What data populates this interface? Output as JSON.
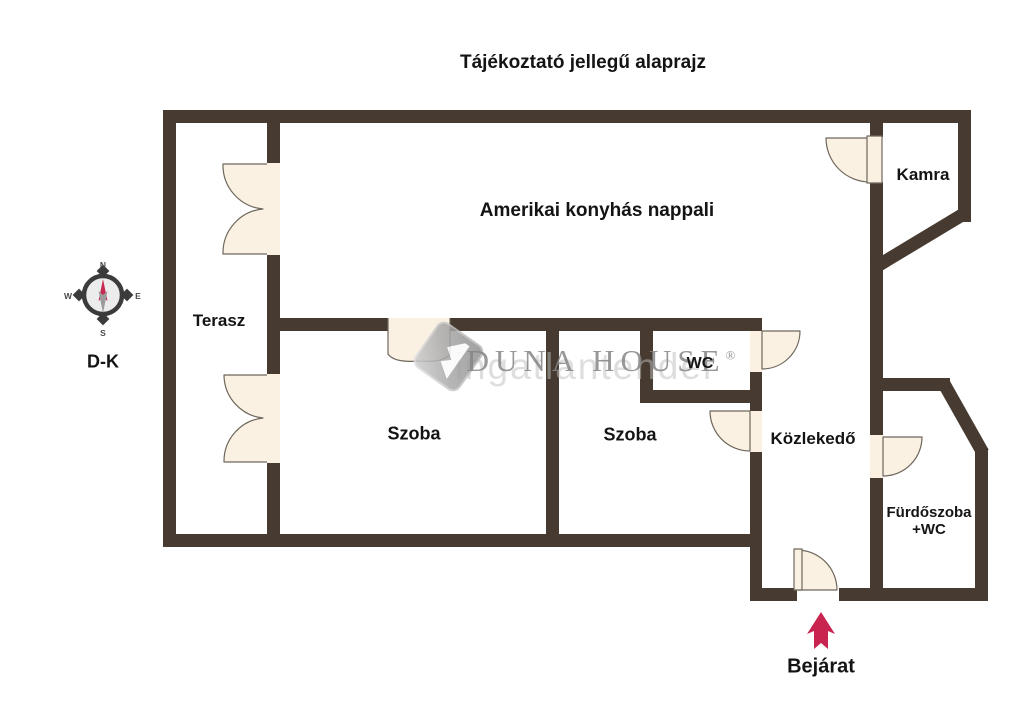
{
  "title": "Tájékoztató jellegű alaprajz",
  "rooms": {
    "terasz": "Terasz",
    "nappali": "Amerikai konyhás nappali",
    "kamra": "Kamra",
    "szoba1": "Szoba",
    "szoba2": "Szoba",
    "wc": "WC",
    "kozlekedo": "Közlekedő",
    "furdoszoba_line1": "Fürdőszoba",
    "furdoszoba_line2": "+WC"
  },
  "entrance": {
    "label": "Bejárat"
  },
  "compass": {
    "label": "D-K",
    "north": "N",
    "east": "E",
    "south": "S",
    "west": "W"
  },
  "watermark": {
    "brand": "DUNA HOUSE",
    "registered": "®",
    "shadow_text": "ingatlantender"
  },
  "icons": {
    "compass": "compass-rose-icon",
    "entrance_arrow": "up-arrow-icon",
    "brand_logo": "diamond-logo-icon"
  },
  "colors": {
    "wall": "#473B31",
    "door_fill": "#FAF1E3",
    "door_stroke": "#6E675C",
    "accent_red": "#C9234F",
    "watermark_gray": "#858585"
  }
}
